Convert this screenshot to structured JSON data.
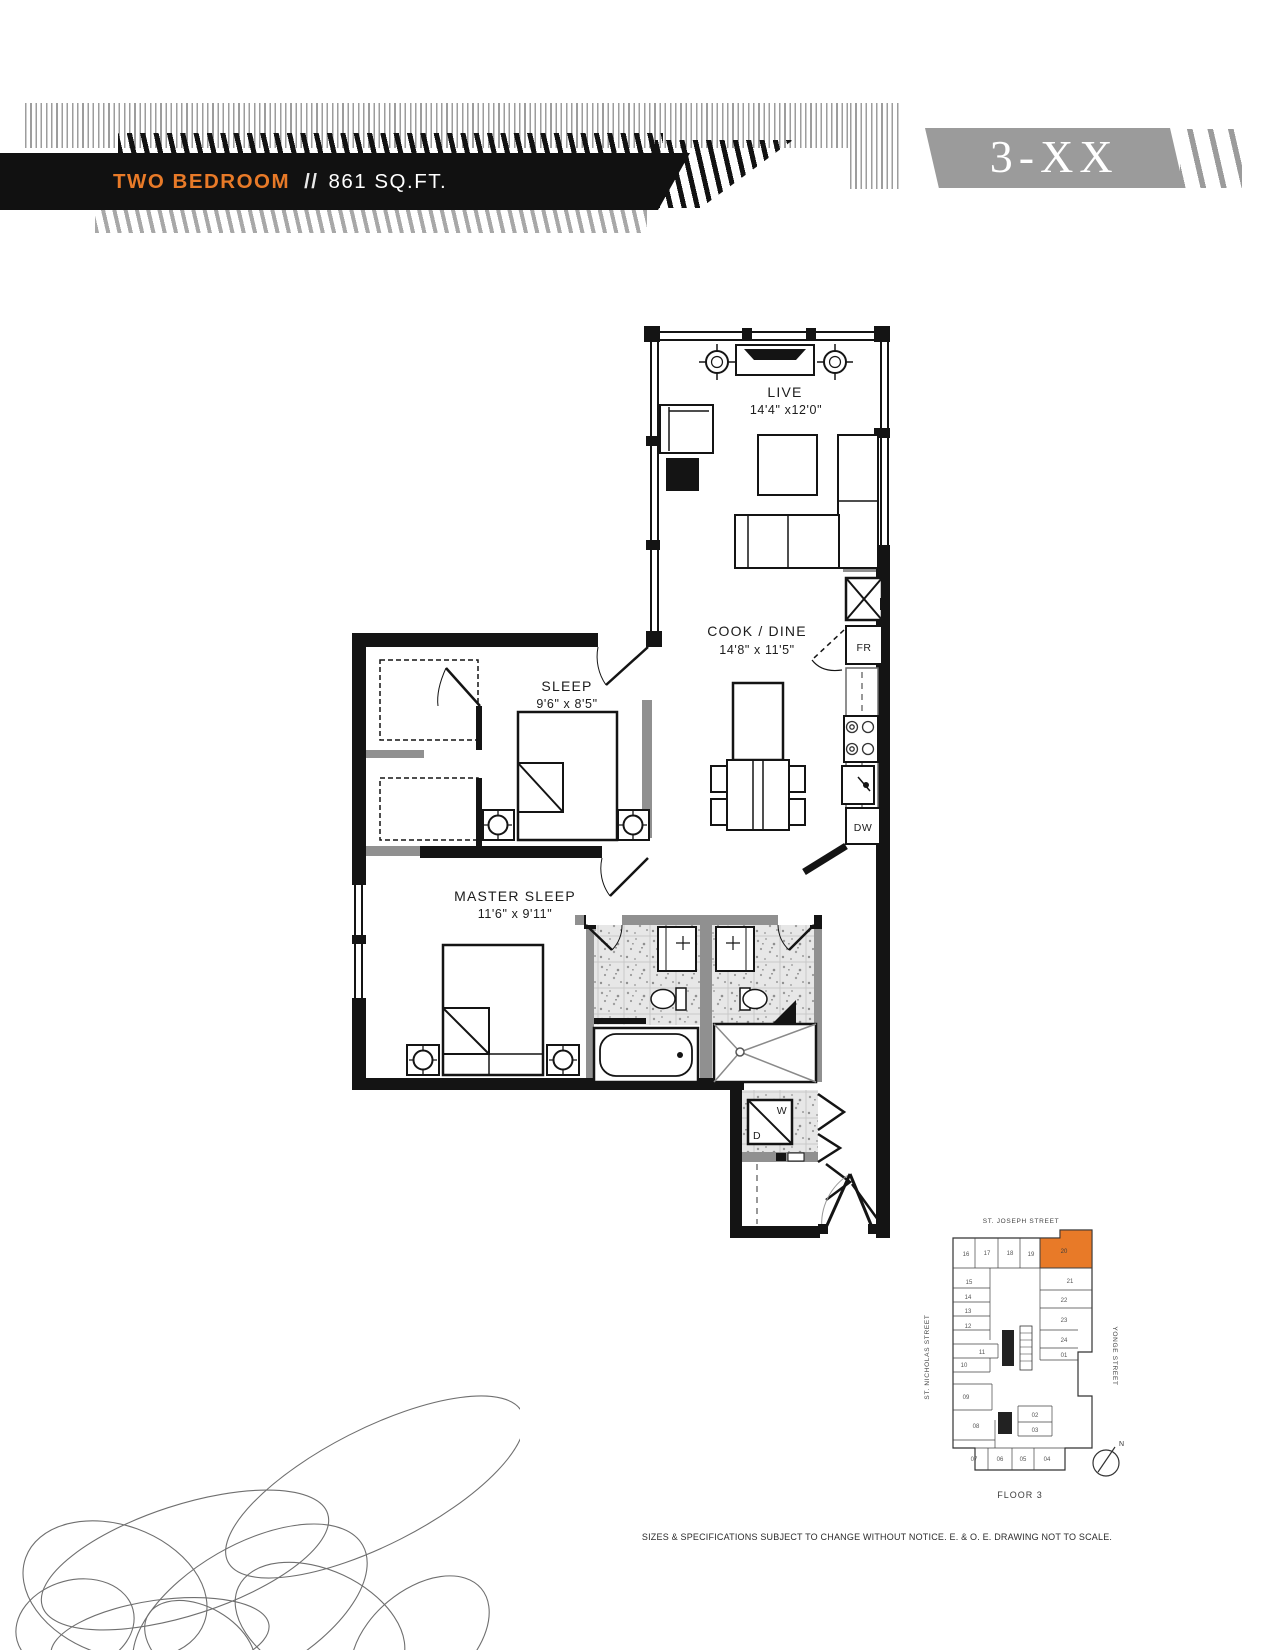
{
  "header": {
    "plan_type": "TWO BEDROOM",
    "separator": "//",
    "area": "861 SQ.FT.",
    "unit_tag": "3-XX"
  },
  "colors": {
    "accent": "#E87A28",
    "tag_gray": "#9B9B9B"
  },
  "floorplan": {
    "rooms": [
      {
        "name": "LIVE",
        "dims": "14'4\" x12'0\""
      },
      {
        "name": "COOK / DINE",
        "dims": "14'8\" x 11'5\""
      },
      {
        "name": "SLEEP",
        "dims": "9'6\" x 8'5\""
      },
      {
        "name": "MASTER SLEEP",
        "dims": "11'6\" x 9'11\""
      }
    ],
    "labels": {
      "fridge": "FR",
      "dishwasher": "DW",
      "washer": "W",
      "dryer": "D"
    }
  },
  "keyplan": {
    "street_top": "ST. JOSEPH STREET",
    "street_left": "ST. NICHOLAS STREET",
    "street_right": "YONGE STREET",
    "floor_label": "FLOOR 3",
    "north_label": "N",
    "highlighted_unit": "20",
    "units": [
      {
        "label": "16"
      },
      {
        "label": "17"
      },
      {
        "label": "18"
      },
      {
        "label": "19"
      },
      {
        "label": "20"
      },
      {
        "label": "21"
      },
      {
        "label": "22"
      },
      {
        "label": "23"
      },
      {
        "label": "24"
      },
      {
        "label": "01"
      },
      {
        "label": "02"
      },
      {
        "label": "03"
      },
      {
        "label": "04"
      },
      {
        "label": "05"
      },
      {
        "label": "06"
      },
      {
        "label": "07"
      },
      {
        "label": "08"
      },
      {
        "label": "09"
      },
      {
        "label": "10"
      },
      {
        "label": "11"
      },
      {
        "label": "12"
      },
      {
        "label": "13"
      },
      {
        "label": "14"
      },
      {
        "label": "15"
      }
    ]
  },
  "footer": {
    "disclaimer": "SIZES & SPECIFICATIONS SUBJECT TO CHANGE WITHOUT NOTICE. E. & O. E. DRAWING NOT TO SCALE."
  }
}
